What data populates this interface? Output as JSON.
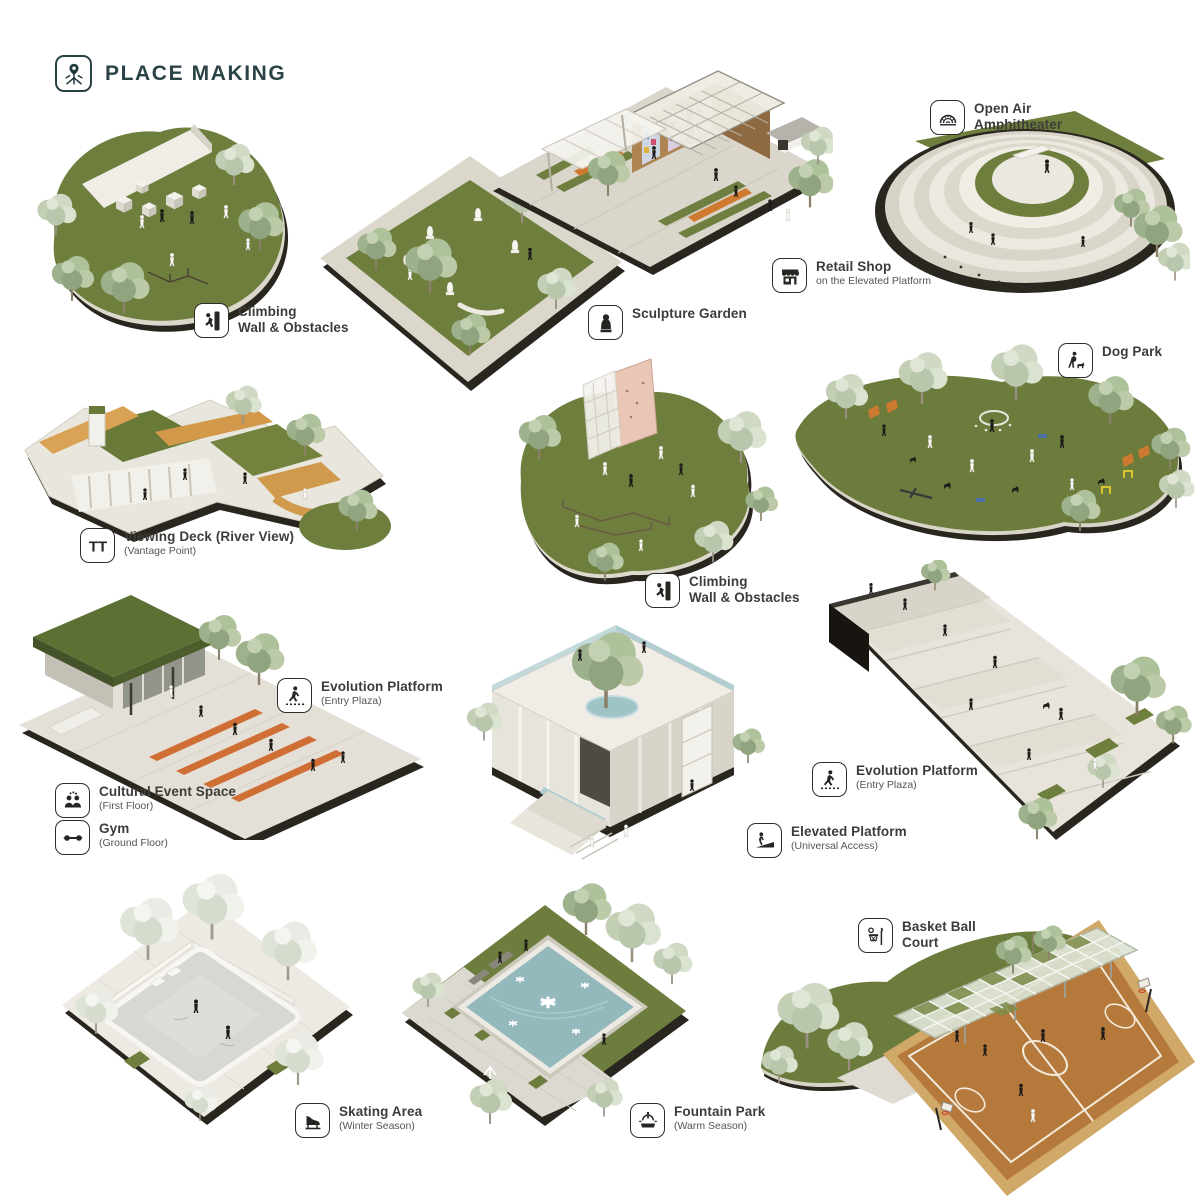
{
  "header": {
    "title": "PLACE MAKING",
    "icon": "place-making-pin-icon"
  },
  "features": {
    "climbing1": {
      "line1": "Climbing",
      "line2": "Wall & Obstacles",
      "icon": "climbing-icon"
    },
    "sculpture": {
      "line1": "Sculpture Garden",
      "icon": "sculpture-icon"
    },
    "retail": {
      "line1": "Retail Shop",
      "sub": "on the Elevated Platform",
      "icon": "retail-shop-icon"
    },
    "amphitheater": {
      "line1": "Open Air",
      "line2": "Amphitheater",
      "icon": "amphitheater-icon"
    },
    "viewing_deck": {
      "line1": "Viewing Deck (River View)",
      "sub": "(Vantage Point)",
      "icon": "viewing-deck-icon"
    },
    "climbing2": {
      "line1": "Climbing",
      "line2": "Wall & Obstacles",
      "icon": "climbing-icon"
    },
    "dog_park": {
      "line1": "Dog Park",
      "icon": "dog-park-icon"
    },
    "evolution1": {
      "line1": "Evolution Platform",
      "sub": "(Entry Plaza)",
      "icon": "evolution-platform-icon"
    },
    "cultural": {
      "line1": "Cultural Event Space",
      "sub": "(First Floor)",
      "icon": "cultural-event-icon"
    },
    "gym": {
      "line1": "Gym",
      "sub": "(Ground Floor)",
      "icon": "gym-dumbbell-icon"
    },
    "elevated": {
      "line1": "Elevated Platform",
      "sub": "(Universal Access)",
      "icon": "elevated-ramp-icon"
    },
    "evolution2": {
      "line1": "Evolution Platform",
      "sub": "(Entry Plaza)",
      "icon": "evolution-platform-icon"
    },
    "skating": {
      "line1": "Skating Area",
      "sub": "(Winter Season)",
      "icon": "skating-icon"
    },
    "fountain": {
      "line1": "Fountain Park",
      "sub": "(Warm Season)",
      "icon": "fountain-icon"
    },
    "basketball": {
      "line1": "Basket Ball",
      "line2": "Court",
      "icon": "basketball-icon"
    }
  },
  "colors": {
    "header_text": "#2b4347",
    "label_text": "#3e3c39",
    "lawn_green": "#6e7e3d",
    "pale_tree": "#cfd9c3",
    "pavement": "#dfdbd2",
    "wood_tan": "#d9a255",
    "bench_orange": "#cf6a2d",
    "pool_blue": "#93b9bd",
    "court_orange": "#b5793c",
    "base_dark": "#2a2620",
    "background": "#ffffff"
  }
}
